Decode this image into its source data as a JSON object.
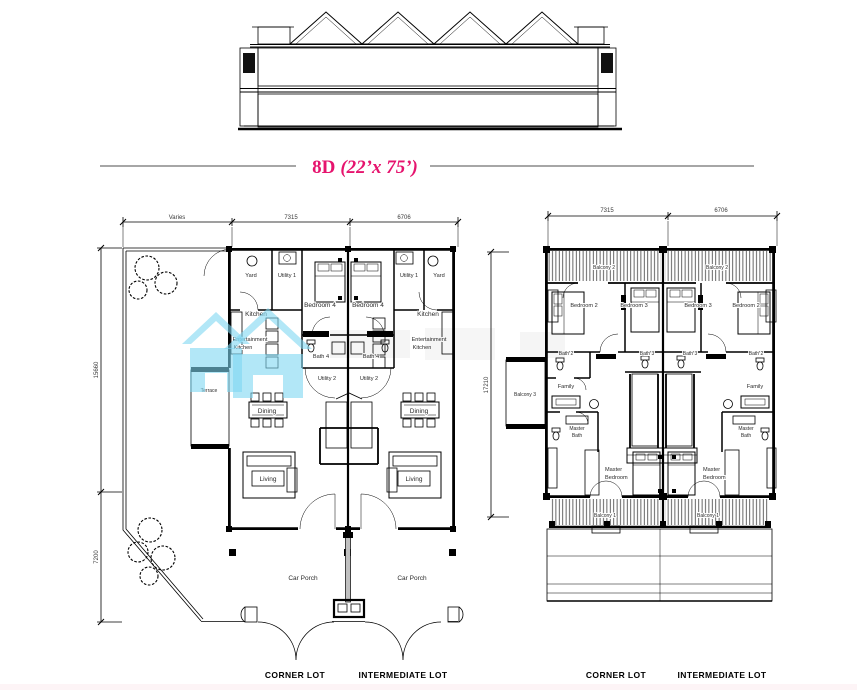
{
  "title": {
    "code": "8D",
    "size": "(22’x 75’)"
  },
  "colors": {
    "accent_pink": "#e6146e",
    "watermark_blue": "#7ed7f2",
    "line": "#000000"
  },
  "footers": {
    "corner": "CORNER LOT",
    "intermediate": "INTERMEDIATE LOT"
  },
  "ground_floor": {
    "dims": {
      "top": [
        "Varies",
        "7315",
        "6706"
      ],
      "left": [
        "15660",
        "7200"
      ]
    },
    "rooms": {
      "yard": "Yard",
      "utility1": "Utility 1",
      "kitchen": "Kitchen",
      "bedroom4": "Bedroom 4",
      "ent_kitchen_line1": "Entertainment",
      "ent_kitchen_line2": "Kitchen",
      "bath4": "Bath 4",
      "utility2": "Utility 2",
      "terrace": "Terrace",
      "dining": "Dining",
      "living": "Living",
      "car_porch": "Car Porch"
    }
  },
  "first_floor": {
    "dims": {
      "top": [
        "7315",
        "6706"
      ],
      "left": [
        "17210"
      ]
    },
    "rooms": {
      "balcony1": "Balcony 1",
      "balcony2": "Balcony 2",
      "balcony3": "Balcony 3",
      "bedroom2": "Bedroom 2",
      "bedroom3": "Bedroom 3",
      "bath2": "Bath 2",
      "bath3": "Bath 3",
      "family": "Family",
      "master_bath_line1": "Master",
      "master_bath_line2": "Bath",
      "master_bedroom_line1": "Master",
      "master_bedroom_line2": "Bedroom"
    }
  }
}
